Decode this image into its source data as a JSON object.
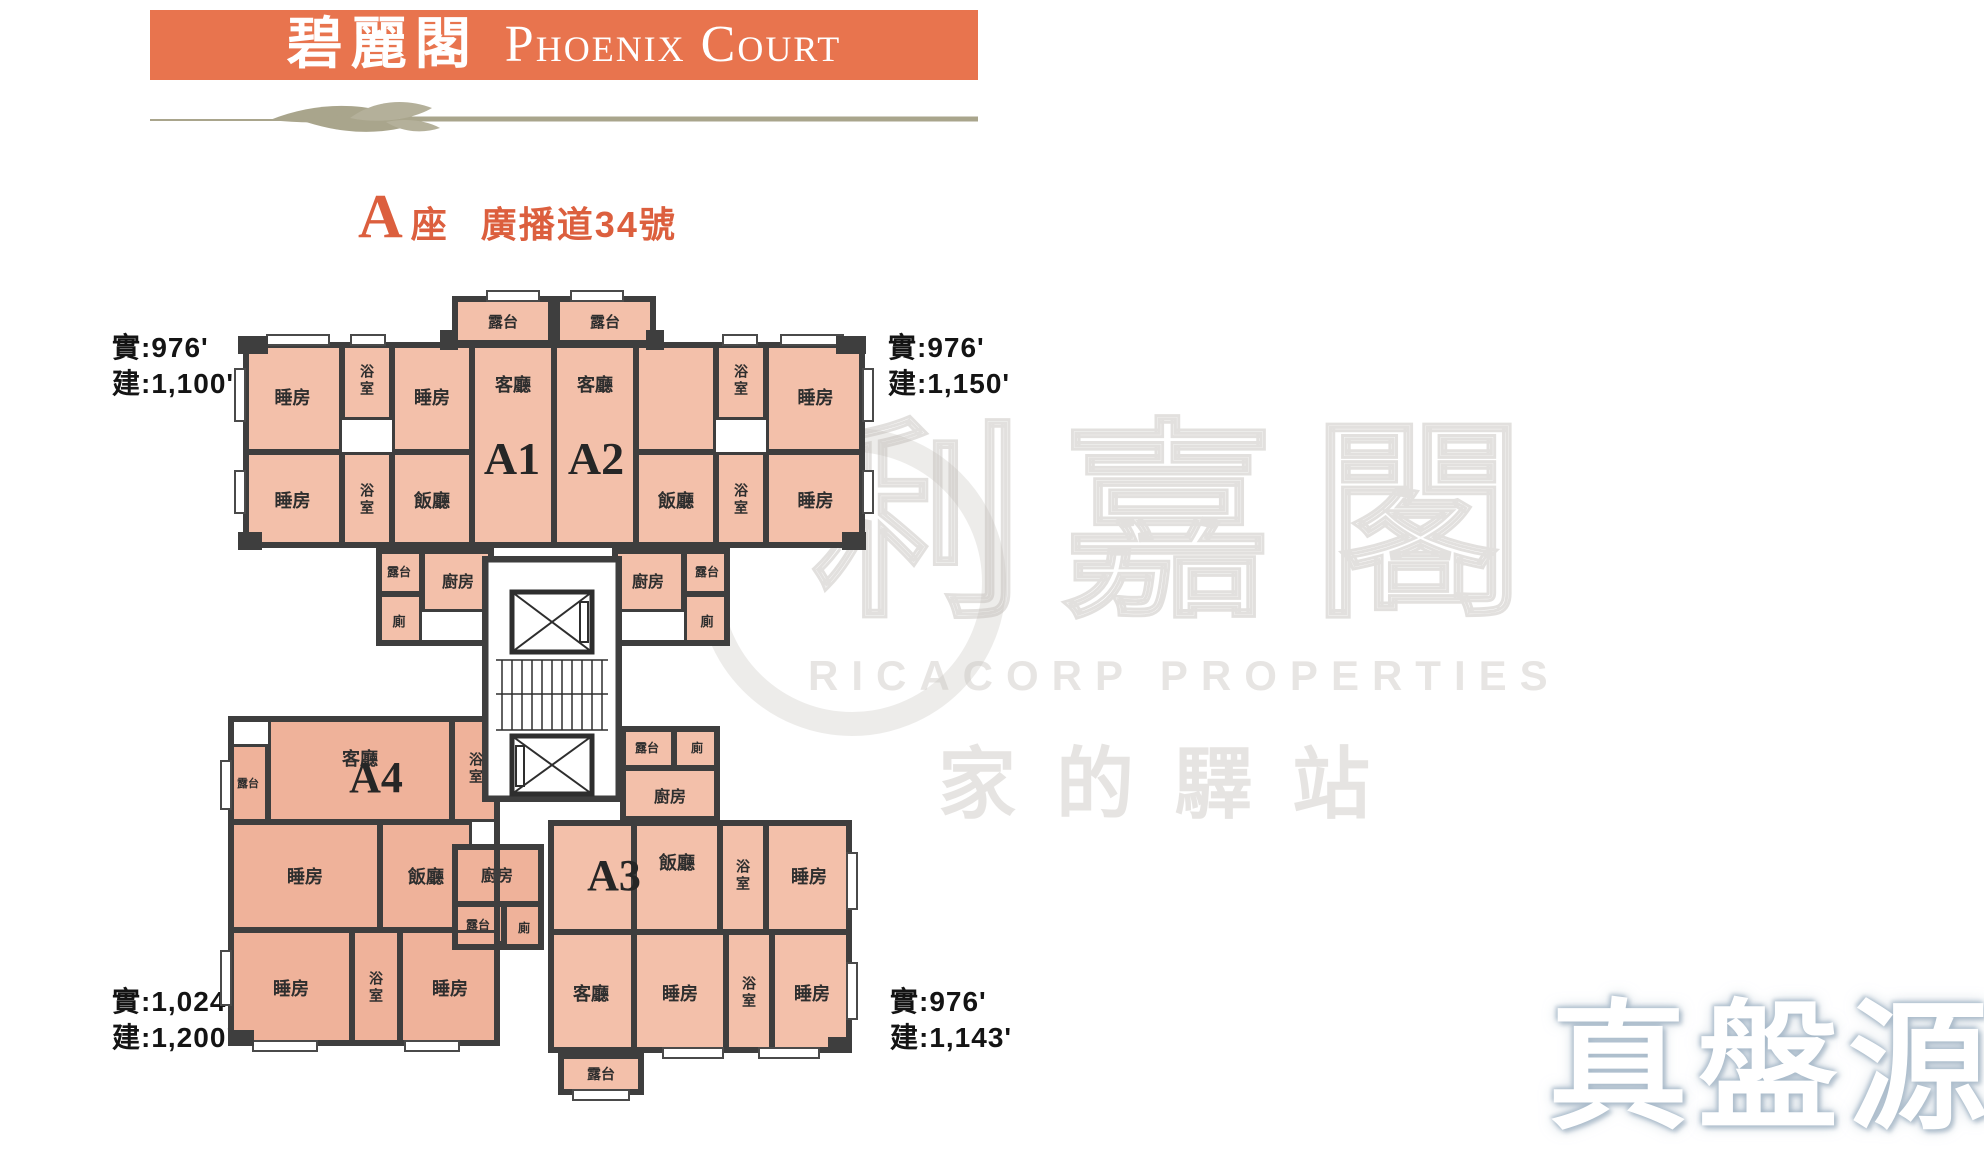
{
  "header": {
    "title_zh": "碧麗閣",
    "title_en": "Phoenix Court"
  },
  "block_title": {
    "letter": "A",
    "suffix": "座",
    "address": "廣播道34號"
  },
  "area_labels": {
    "top_left": {
      "line1": "實:976'",
      "line2": "建:1,100'"
    },
    "top_right": {
      "line1": "實:976'",
      "line2": "建:1,150'"
    },
    "bottom_left": {
      "line1": "實:1,024'",
      "line2": "建:1,200'"
    },
    "bottom_right": {
      "line1": "實:976'",
      "line2": "建:1,143'"
    }
  },
  "watermarks": {
    "center_main": "利嘉閣",
    "center_sub": "RICACORP PROPERTIES",
    "center_tagline": "家的驛站",
    "corner": "真盤源"
  },
  "colors": {
    "header_bg": "#E8744E",
    "header_text": "#FFFFFF",
    "accent": "#DC5F3E",
    "divider": "#A9A58C",
    "wall": "#3E3E3E",
    "room_fill": "#F3C0AA",
    "room_fill_deep": "#EFB29A",
    "label_text": "#2E2E2E"
  },
  "plan": {
    "unit_labels": [
      {
        "t": "A1",
        "x": 466,
        "y": 436,
        "w": 92,
        "fs": 46
      },
      {
        "t": "A2",
        "x": 550,
        "y": 436,
        "w": 92,
        "fs": 46
      },
      {
        "t": "A3",
        "x": 568,
        "y": 854,
        "w": 92,
        "fs": 44
      },
      {
        "t": "A4",
        "x": 330,
        "y": 756,
        "w": 92,
        "fs": 44
      }
    ],
    "rooms": [
      {
        "n": "a1-balcony-top",
        "l": "露台",
        "x": 452,
        "y": 296,
        "w": 102,
        "h": 50,
        "fs": 15
      },
      {
        "n": "a2-balcony-top",
        "l": "露台",
        "x": 554,
        "y": 296,
        "w": 102,
        "h": 50,
        "fs": 15
      },
      {
        "n": "a1-bedroom-1",
        "l": "睡房",
        "x": 243,
        "y": 342,
        "w": 99,
        "h": 110
      },
      {
        "n": "a1-bathroom-1",
        "l": "浴室",
        "x": 342,
        "y": 342,
        "w": 50,
        "h": 78,
        "vert": true,
        "fs": 14
      },
      {
        "n": "a1-bedroom-2",
        "l": "睡房",
        "x": 392,
        "y": 342,
        "w": 80,
        "h": 110
      },
      {
        "n": "a1-living",
        "l": "客廳",
        "x": 472,
        "y": 342,
        "w": 82,
        "h": 206,
        "top": true
      },
      {
        "n": "a2-living",
        "l": "客廳",
        "x": 554,
        "y": 342,
        "w": 82,
        "h": 206,
        "top": true
      },
      {
        "n": "a2-store-room",
        "l": "",
        "x": 636,
        "y": 342,
        "w": 80,
        "h": 110
      },
      {
        "n": "a2-bathroom-1",
        "l": "浴室",
        "x": 716,
        "y": 342,
        "w": 50,
        "h": 78,
        "vert": true,
        "fs": 14
      },
      {
        "n": "a2-bedroom-1",
        "l": "睡房",
        "x": 766,
        "y": 342,
        "w": 99,
        "h": 110
      },
      {
        "n": "a1-bedroom-3",
        "l": "睡房",
        "x": 243,
        "y": 452,
        "w": 99,
        "h": 96
      },
      {
        "n": "a1-bathroom-2",
        "l": "浴室",
        "x": 342,
        "y": 452,
        "w": 50,
        "h": 96,
        "vert": true,
        "fs": 14
      },
      {
        "n": "a1-dining",
        "l": "飯廳",
        "x": 392,
        "y": 452,
        "w": 80,
        "h": 96
      },
      {
        "n": "a2-dining",
        "l": "飯廳",
        "x": 636,
        "y": 452,
        "w": 80,
        "h": 96
      },
      {
        "n": "a2-bathroom-2",
        "l": "浴室",
        "x": 716,
        "y": 452,
        "w": 50,
        "h": 96,
        "vert": true,
        "fs": 14
      },
      {
        "n": "a2-bedroom-2",
        "l": "睡房",
        "x": 766,
        "y": 452,
        "w": 99,
        "h": 96
      },
      {
        "n": "a1-kitchen-balcony",
        "l": "露台",
        "x": 376,
        "y": 548,
        "w": 46,
        "h": 46,
        "fs": 12
      },
      {
        "n": "a1-kitchen",
        "l": "廚房",
        "x": 422,
        "y": 548,
        "w": 72,
        "h": 64,
        "fs": 16
      },
      {
        "n": "a1-toilet",
        "l": "廁",
        "x": 376,
        "y": 594,
        "w": 46,
        "h": 52,
        "fs": 13
      },
      {
        "n": "a2-kitchen",
        "l": "廚房",
        "x": 612,
        "y": 548,
        "w": 72,
        "h": 64,
        "fs": 16
      },
      {
        "n": "a2-kitchen-balcony",
        "l": "露台",
        "x": 684,
        "y": 548,
        "w": 46,
        "h": 46,
        "fs": 12
      },
      {
        "n": "a2-toilet",
        "l": "廁",
        "x": 684,
        "y": 594,
        "w": 46,
        "h": 52,
        "fs": 13
      },
      {
        "n": "a4-balcony",
        "l": "露台",
        "x": 228,
        "y": 744,
        "w": 40,
        "h": 78,
        "fs": 11,
        "tone": "b"
      },
      {
        "n": "a4-living",
        "l": "客廳",
        "x": 268,
        "y": 716,
        "w": 184,
        "h": 106,
        "top": true,
        "tone": "b"
      },
      {
        "n": "a4-bathroom-1",
        "l": "浴室",
        "x": 452,
        "y": 716,
        "w": 48,
        "h": 106,
        "vert": true,
        "fs": 14,
        "tone": "b"
      },
      {
        "n": "a4-bedroom-1",
        "l": "睡房",
        "x": 230,
        "y": 822,
        "w": 150,
        "h": 108,
        "tone": "b"
      },
      {
        "n": "a4-dining",
        "l": "飯廳",
        "x": 380,
        "y": 822,
        "w": 92,
        "h": 108,
        "tone": "b"
      },
      {
        "n": "a4-kitchen",
        "l": "廚房",
        "x": 452,
        "y": 844,
        "w": 90,
        "h": 60,
        "fs": 16,
        "tone": "b"
      },
      {
        "n": "a4-kitchen-balcony",
        "l": "露台",
        "x": 452,
        "y": 904,
        "w": 52,
        "h": 40,
        "fs": 12,
        "tone": "b"
      },
      {
        "n": "a4-toilet",
        "l": "廁",
        "x": 504,
        "y": 904,
        "w": 40,
        "h": 46,
        "fs": 12,
        "tone": "b"
      },
      {
        "n": "a4-bedroom-2",
        "l": "睡房",
        "x": 230,
        "y": 930,
        "w": 122,
        "h": 116,
        "tone": "b"
      },
      {
        "n": "a4-bathroom-2",
        "l": "浴室",
        "x": 352,
        "y": 930,
        "w": 48,
        "h": 116,
        "vert": true,
        "fs": 14,
        "tone": "b"
      },
      {
        "n": "a4-bedroom-3",
        "l": "睡房",
        "x": 400,
        "y": 930,
        "w": 100,
        "h": 116,
        "tone": "b"
      },
      {
        "n": "a3-balcony-top",
        "l": "露台",
        "x": 620,
        "y": 726,
        "w": 54,
        "h": 42,
        "fs": 12
      },
      {
        "n": "a3-toilet",
        "l": "廁",
        "x": 674,
        "y": 726,
        "w": 46,
        "h": 42,
        "fs": 12
      },
      {
        "n": "a3-kitchen",
        "l": "廚房",
        "x": 620,
        "y": 768,
        "w": 100,
        "h": 54,
        "fs": 16
      },
      {
        "n": "a3-hall",
        "l": "",
        "x": 548,
        "y": 820,
        "w": 86,
        "h": 112
      },
      {
        "n": "a3-dining",
        "l": "飯廳",
        "x": 634,
        "y": 820,
        "w": 86,
        "h": 112,
        "top": true
      },
      {
        "n": "a3-bathroom-1",
        "l": "浴室",
        "x": 720,
        "y": 820,
        "w": 46,
        "h": 112,
        "vert": true,
        "fs": 14
      },
      {
        "n": "a3-bedroom-1",
        "l": "睡房",
        "x": 766,
        "y": 820,
        "w": 86,
        "h": 112
      },
      {
        "n": "a3-living",
        "l": "客廳",
        "x": 548,
        "y": 932,
        "w": 86,
        "h": 121
      },
      {
        "n": "a3-bedroom-2",
        "l": "睡房",
        "x": 634,
        "y": 932,
        "w": 92,
        "h": 121
      },
      {
        "n": "a3-bathroom-2",
        "l": "浴室",
        "x": 726,
        "y": 932,
        "w": 46,
        "h": 121,
        "vert": true,
        "fs": 14
      },
      {
        "n": "a3-bedroom-3",
        "l": "睡房",
        "x": 772,
        "y": 932,
        "w": 80,
        "h": 121
      },
      {
        "n": "a3-balcony-bottom",
        "l": "露台",
        "x": 558,
        "y": 1053,
        "w": 86,
        "h": 42,
        "fs": 14
      }
    ],
    "outlines": [
      {
        "x": 243,
        "y": 342,
        "w": 622,
        "h": 206
      },
      {
        "x": 452,
        "y": 296,
        "w": 102,
        "h": 50
      },
      {
        "x": 554,
        "y": 296,
        "w": 102,
        "h": 50
      },
      {
        "x": 376,
        "y": 548,
        "w": 118,
        "h": 98
      },
      {
        "x": 612,
        "y": 548,
        "w": 118,
        "h": 98
      },
      {
        "x": 228,
        "y": 716,
        "w": 272,
        "h": 330
      },
      {
        "x": 452,
        "y": 844,
        "w": 92,
        "h": 106
      },
      {
        "x": 620,
        "y": 726,
        "w": 100,
        "h": 96
      },
      {
        "x": 548,
        "y": 820,
        "w": 304,
        "h": 233
      },
      {
        "x": 558,
        "y": 1053,
        "w": 86,
        "h": 42
      },
      {
        "x": 482,
        "y": 556,
        "w": 140,
        "h": 246
      }
    ],
    "windows": [
      {
        "x": 266,
        "y": 334,
        "w": 64,
        "h": 12
      },
      {
        "x": 350,
        "y": 334,
        "w": 36,
        "h": 12
      },
      {
        "x": 486,
        "y": 290,
        "w": 54,
        "h": 12
      },
      {
        "x": 570,
        "y": 290,
        "w": 54,
        "h": 12
      },
      {
        "x": 722,
        "y": 334,
        "w": 36,
        "h": 12
      },
      {
        "x": 780,
        "y": 334,
        "w": 64,
        "h": 12
      },
      {
        "x": 234,
        "y": 368,
        "w": 12,
        "h": 54
      },
      {
        "x": 234,
        "y": 470,
        "w": 12,
        "h": 44
      },
      {
        "x": 862,
        "y": 368,
        "w": 12,
        "h": 54
      },
      {
        "x": 862,
        "y": 470,
        "w": 12,
        "h": 44
      },
      {
        "x": 220,
        "y": 760,
        "w": 12,
        "h": 50
      },
      {
        "x": 220,
        "y": 950,
        "w": 12,
        "h": 56
      },
      {
        "x": 252,
        "y": 1040,
        "w": 66,
        "h": 12
      },
      {
        "x": 404,
        "y": 1040,
        "w": 56,
        "h": 12
      },
      {
        "x": 846,
        "y": 852,
        "w": 12,
        "h": 58
      },
      {
        "x": 846,
        "y": 962,
        "w": 12,
        "h": 58
      },
      {
        "x": 662,
        "y": 1047,
        "w": 62,
        "h": 12
      },
      {
        "x": 758,
        "y": 1047,
        "w": 62,
        "h": 12
      },
      {
        "x": 572,
        "y": 1089,
        "w": 58,
        "h": 12
      }
    ],
    "piers": [
      {
        "x": 238,
        "y": 336,
        "w": 30,
        "h": 18
      },
      {
        "x": 440,
        "y": 330,
        "w": 18,
        "h": 20
      },
      {
        "x": 646,
        "y": 330,
        "w": 18,
        "h": 20
      },
      {
        "x": 836,
        "y": 336,
        "w": 30,
        "h": 18
      },
      {
        "x": 238,
        "y": 532,
        "w": 24,
        "h": 18
      },
      {
        "x": 842,
        "y": 532,
        "w": 24,
        "h": 18
      },
      {
        "x": 228,
        "y": 1030,
        "w": 26,
        "h": 16
      },
      {
        "x": 828,
        "y": 1037,
        "w": 24,
        "h": 16
      }
    ]
  }
}
